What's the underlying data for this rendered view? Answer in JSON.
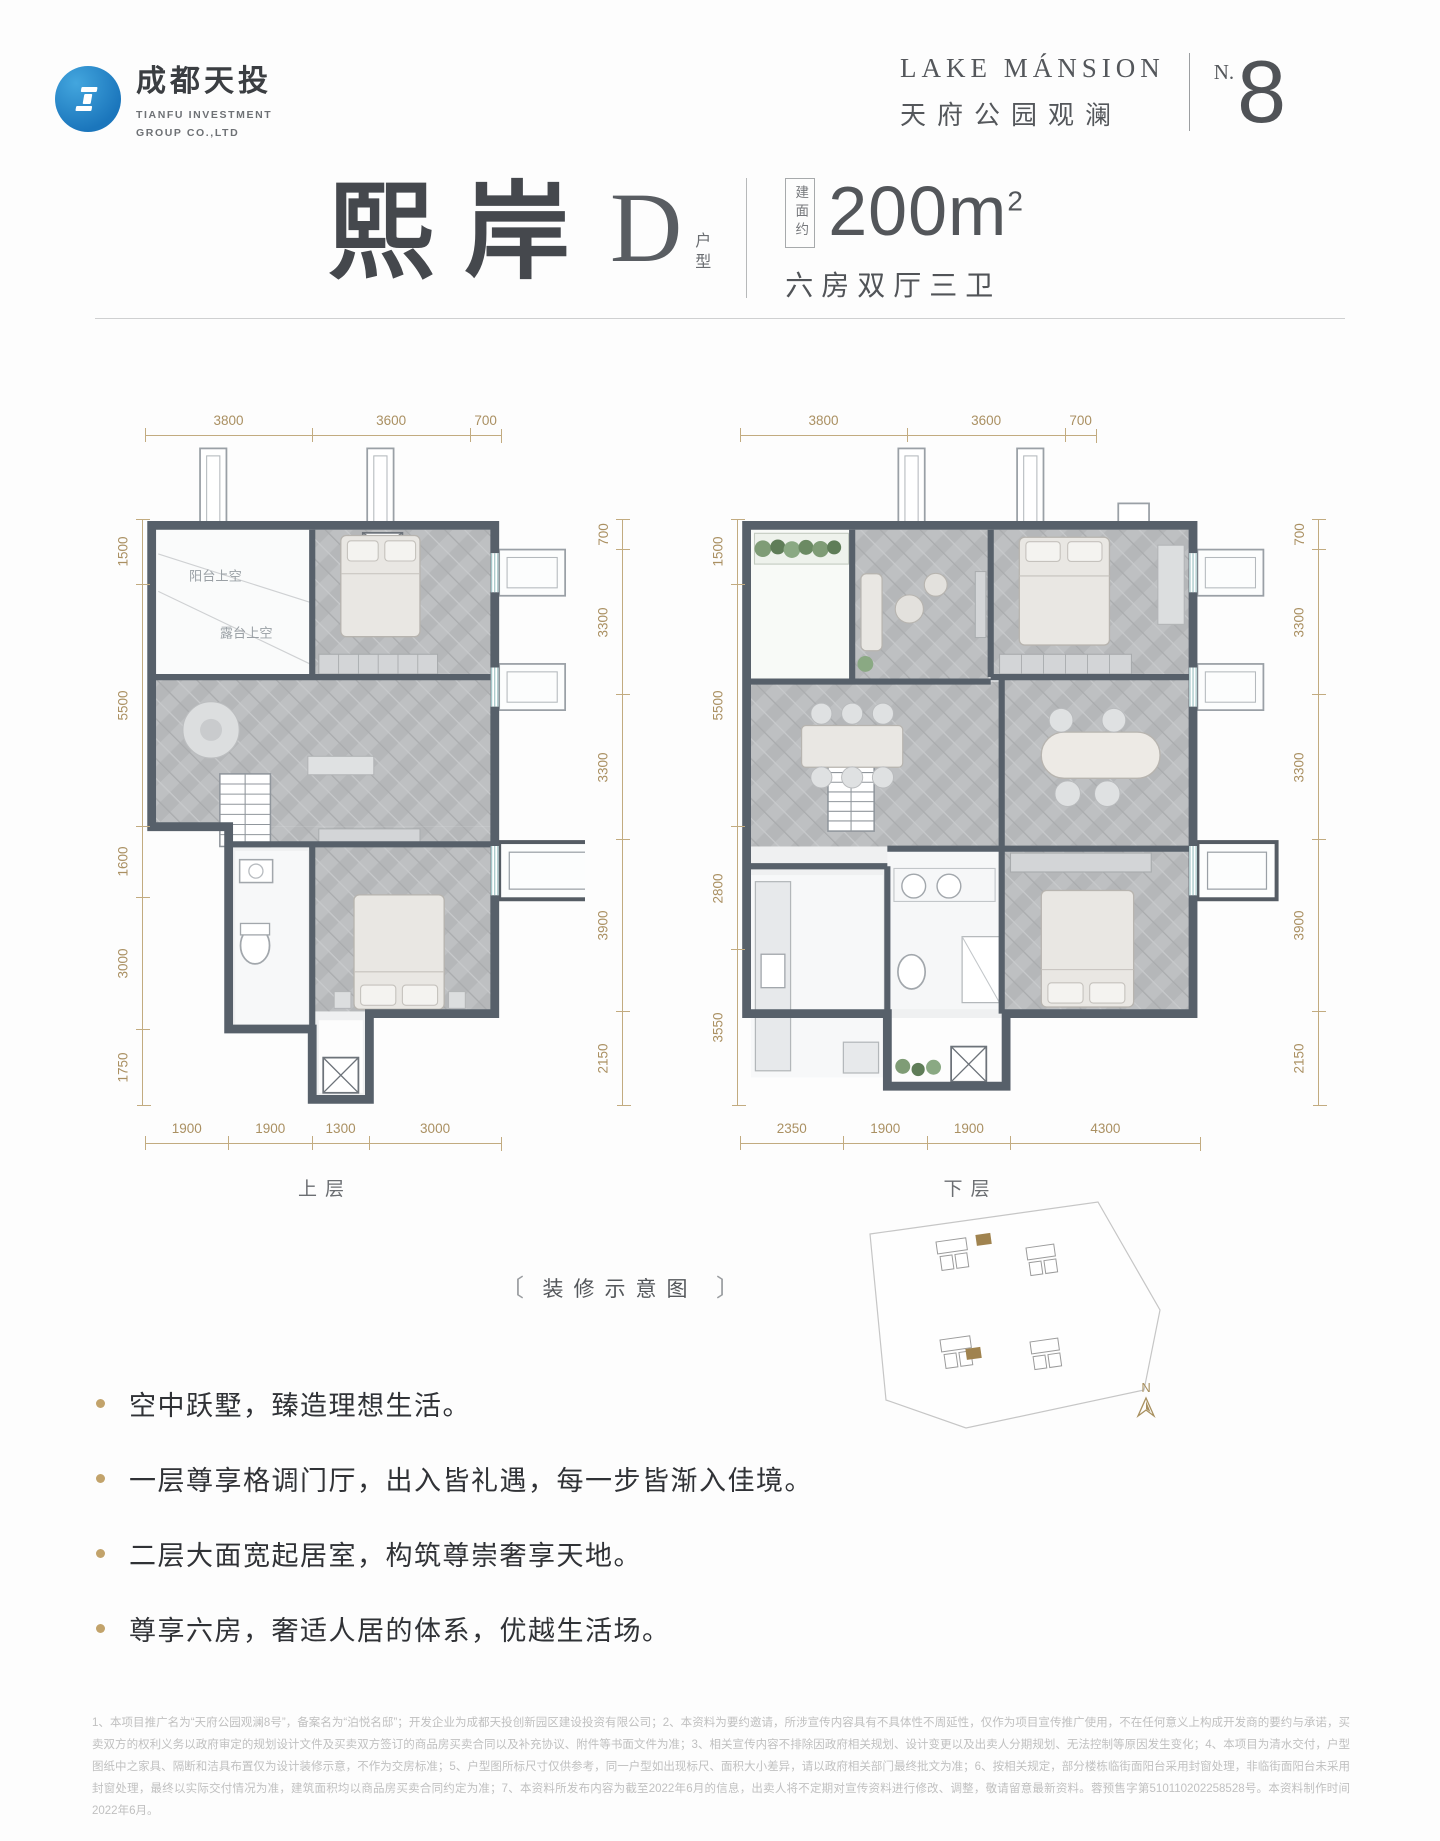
{
  "brand": {
    "name_cn": "成都天投",
    "name_en_1": "TIANFU INVESTMENT",
    "name_en_2": "GROUP CO.,LTD"
  },
  "project": {
    "name_en": "LAKE MÁNSION",
    "name_cn": "天府公园观澜",
    "number_label": "N.",
    "number": "8"
  },
  "unit": {
    "name": "熙岸",
    "type": "D",
    "type_suffix": "户型",
    "area_prefix": "建面约",
    "area": "200m",
    "area_sup": "2",
    "rooms": "六房双厅三卫"
  },
  "plans": [
    {
      "label": "上层",
      "dims_top": [
        "3800",
        "3600",
        "700"
      ],
      "dims_left": [
        "1500",
        "5500",
        "1600",
        "3000",
        "1750"
      ],
      "dims_right": [
        "700",
        "3300",
        "3300",
        "3900",
        "2150"
      ],
      "dims_bottom": [
        "1900",
        "1900",
        "1300",
        "3000"
      ],
      "notes": [
        "阳台上空",
        "露台上空"
      ]
    },
    {
      "label": "下层",
      "dims_top": [
        "3800",
        "3600",
        "700"
      ],
      "dims_left": [
        "1500",
        "5500",
        "2800",
        "3550"
      ],
      "dims_right": [
        "700",
        "3300",
        "3300",
        "3900",
        "2150"
      ],
      "dims_bottom": [
        "2350",
        "1900",
        "1900",
        "4300"
      ]
    }
  ],
  "caption": {
    "left_bracket": "〔",
    "text": "装修示意图",
    "right_bracket": "〕"
  },
  "bullets": [
    "空中跃墅，臻造理想生活。",
    "一层尊享格调门厅，出入皆礼遇，每一步皆渐入佳境。",
    "二层大面宽起居室，构筑尊崇奢享天地。",
    "尊享六房，奢适人居的体系，优越生活场。"
  ],
  "siteplan": {
    "compass": "N"
  },
  "disclaimer": "1、本项目推广名为“天府公园观澜8号”，备案名为“泊悦名邸”；开发企业为成都天投创新园区建设投资有限公司；2、本资料为要约邀请，所涉宣传内容具有不具体性不周延性，仅作为项目宣传推广使用，不在任何意义上构成开发商的要约与承诺，买卖双方的权利义务以政府审定的规划设计文件及买卖双方签订的商品房买卖合同以及补充协议、附件等书面文件为准；3、相关宣传内容不排除因政府相关规划、设计变更以及出卖人分期规划、无法控制等原因发生变化；4、本项目为清水交付，户型图纸中之家具、隔断和洁具布置仅为设计装修示意，不作为交房标准；5、户型图所标尺寸仅供参考，同一户型如出现标尺、面积大小差异，请以政府相关部门最终批文为准；6、按相关规定，部分楼栋临街面阳台采用封窗处理，非临街面阳台未采用封窗处理，最终以实际交付情况为准，建筑面积均以商品房买卖合同约定为准；7、本资料所发布内容为截至2022年6月的信息，出卖人将不定期对宣传资料进行修改、调整，敬请留意最新资料。蓉预售字第510110202258528号。本资料制作时间2022年6月。",
  "colors": {
    "dim_line": "#c2ab80",
    "dim_text": "#aa9062",
    "accent_gold": "#c2a36b",
    "logo_blue": "#1e7fc2",
    "wall": "#57606a",
    "text_dark": "#45484d",
    "fine_print": "#c0c0c0"
  }
}
